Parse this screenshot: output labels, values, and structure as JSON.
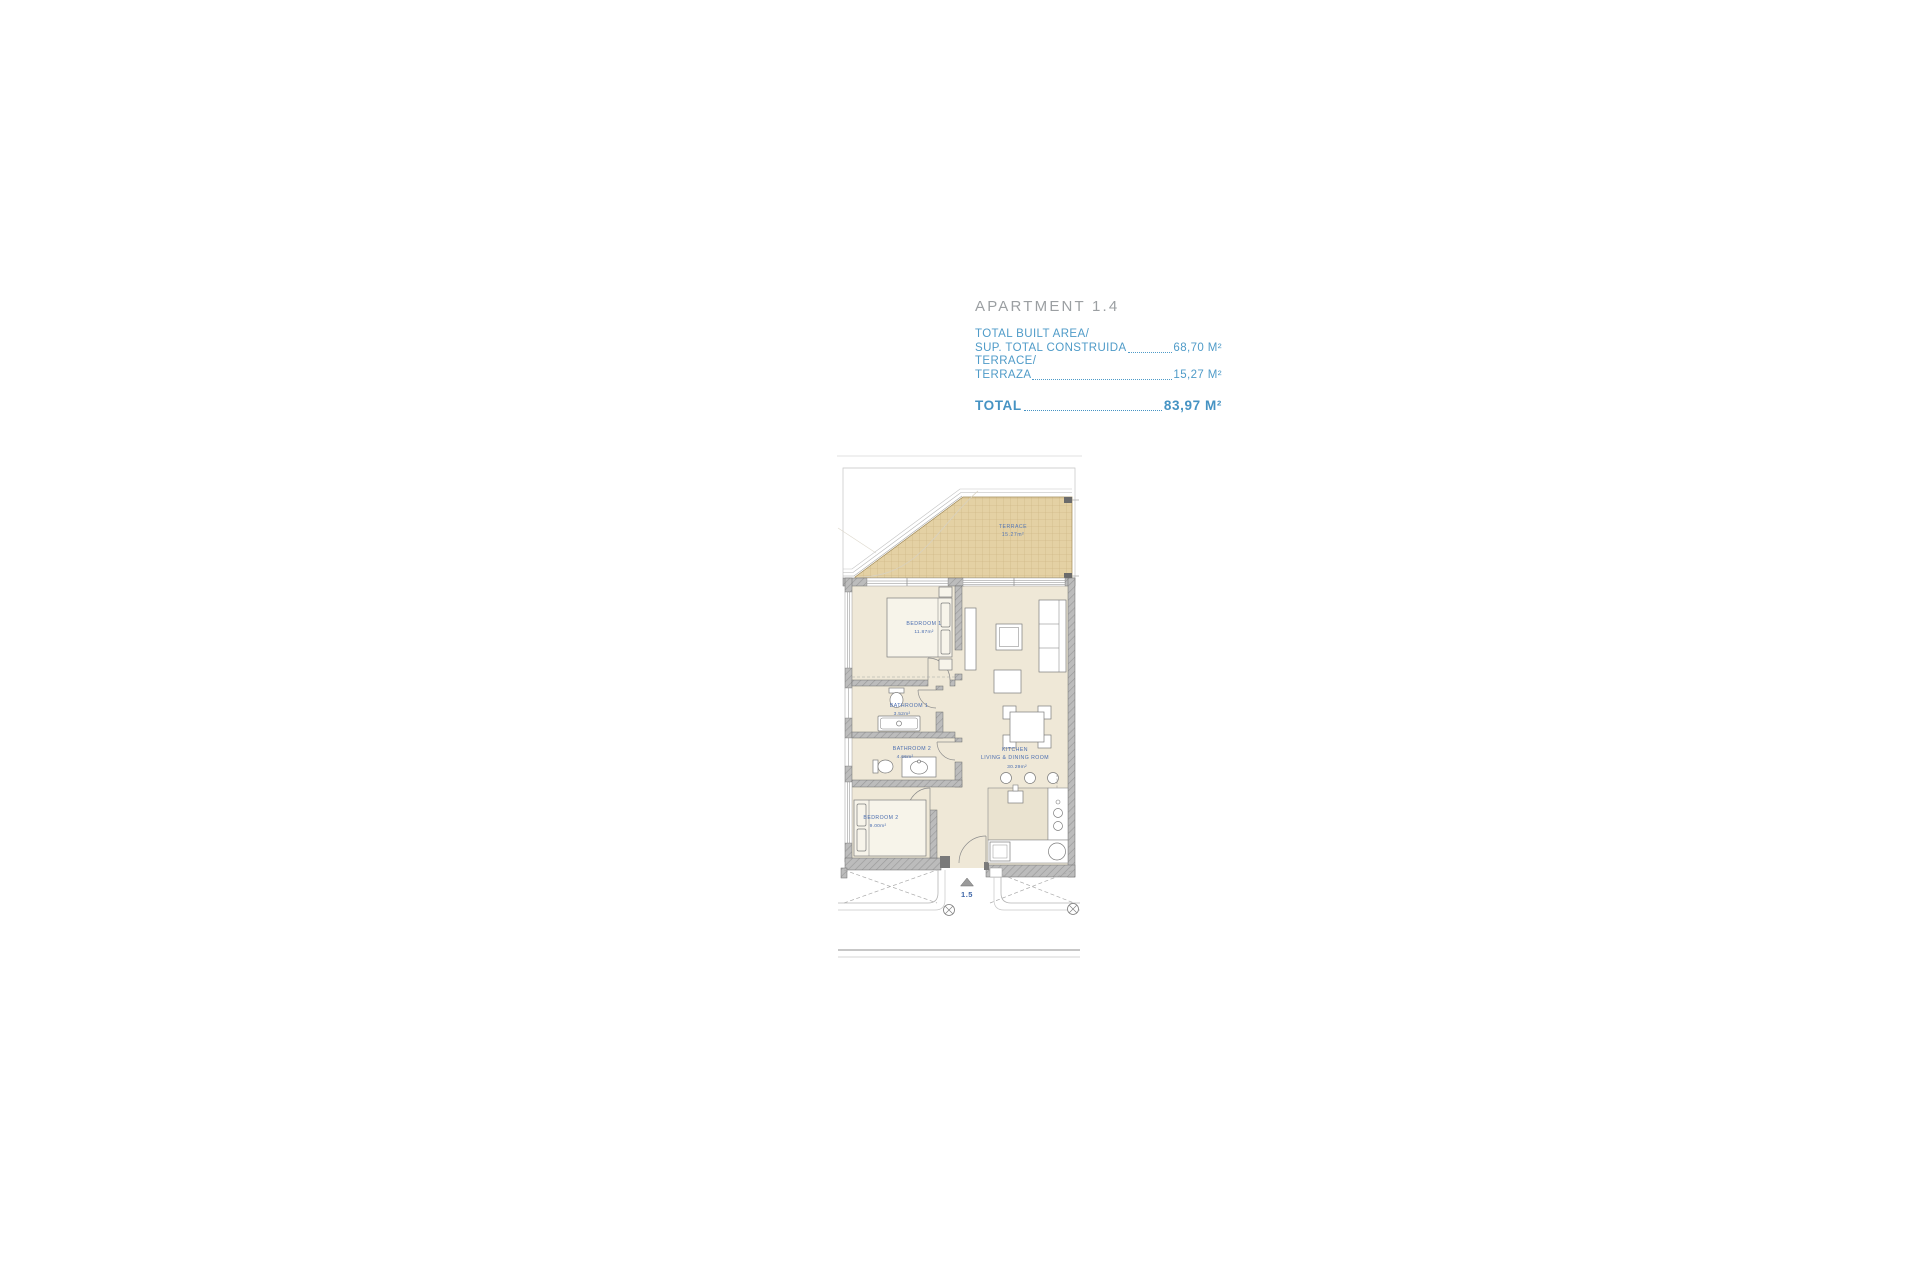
{
  "header": {
    "title": "APARTMENT 1.4"
  },
  "area_summary": {
    "built_label_en": "TOTAL BUILT AREA/",
    "built_label_es": "SUP. TOTAL CONSTRUIDA",
    "built_value": "68,70 M²",
    "terrace_label_en": "TERRACE/",
    "terrace_label_es": "TERRAZA",
    "terrace_value": "15,27 M²",
    "total_label": "TOTAL",
    "total_value": "83,97 M²"
  },
  "floor_plan": {
    "terrace": {
      "name": "TERRACE",
      "area": "15.27m²"
    },
    "bedroom1": {
      "name": "BEDROOM  1",
      "area": "11.87m²"
    },
    "bathroom1": {
      "name": "BATHROOM  1",
      "area": "3.52m²"
    },
    "bathroom2": {
      "name": "BATHROOM  2",
      "area": "4.66m²"
    },
    "bedroom2": {
      "name": "BEDROOM  2",
      "area": "9.00m²"
    },
    "kitchen": {
      "name": "KITCHEN",
      "name2": "LIVING  &  DINING  ROOM",
      "area": "30.29m²"
    },
    "entrance_marker": "1.5",
    "colors": {
      "accent_blue": "#4f9bc8",
      "room_label_blue": "#4a6db0",
      "terrace_fill": "#e4d1a4",
      "floor_fill": "#efe8d7",
      "wall_gray": "#bcbcbc"
    }
  }
}
